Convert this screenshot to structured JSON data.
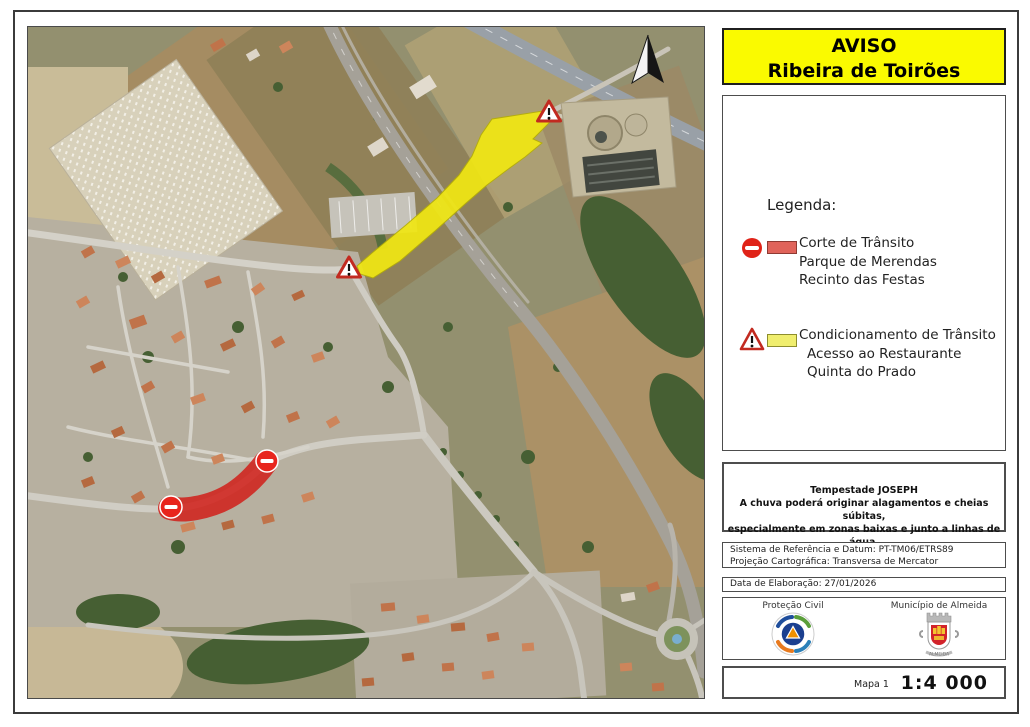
{
  "title": {
    "line1": "AVISO",
    "line2": "Ribeira de Toirões"
  },
  "legend": {
    "heading": "Legenda:",
    "items": [
      {
        "icon": "no-entry",
        "lines": [
          "Corte de Trânsito",
          "Parque de Merendas",
          "Recinto das Festas"
        ]
      },
      {
        "icon": "warning-triangle",
        "lines": [
          "Condicionamento de Trânsito",
          "Acesso ao Restaurante",
          "Quinta do Prado"
        ]
      }
    ]
  },
  "notice": {
    "title": "Tempestade JOSEPH",
    "line1": "A chuva poderá originar alagamentos e cheias súbitas,",
    "line2": "especialmente em zonas baixas e junto a linhas de água."
  },
  "reference": {
    "line1": "Sistema de Referência e Datum: PT-TM06/ETRS89",
    "line2": "Projeção Cartográfica: Transversa de Mercator"
  },
  "date": {
    "label": "Data de Elaboração: 27/01/2026"
  },
  "credits": {
    "left": "Proteção Civil",
    "right": "Município de Almeida",
    "right_motto": "ALMEIDA"
  },
  "footer": {
    "map_label": "Mapa 1",
    "scale": "1:4 000"
  },
  "colors": {
    "title_bg": "#fafa00",
    "closure_red": "#d0201a",
    "legend_red_swatch": "#e0635a",
    "conditioning_yellow": "#f0e714",
    "legend_yellow_swatch": "#f0ee6e"
  }
}
